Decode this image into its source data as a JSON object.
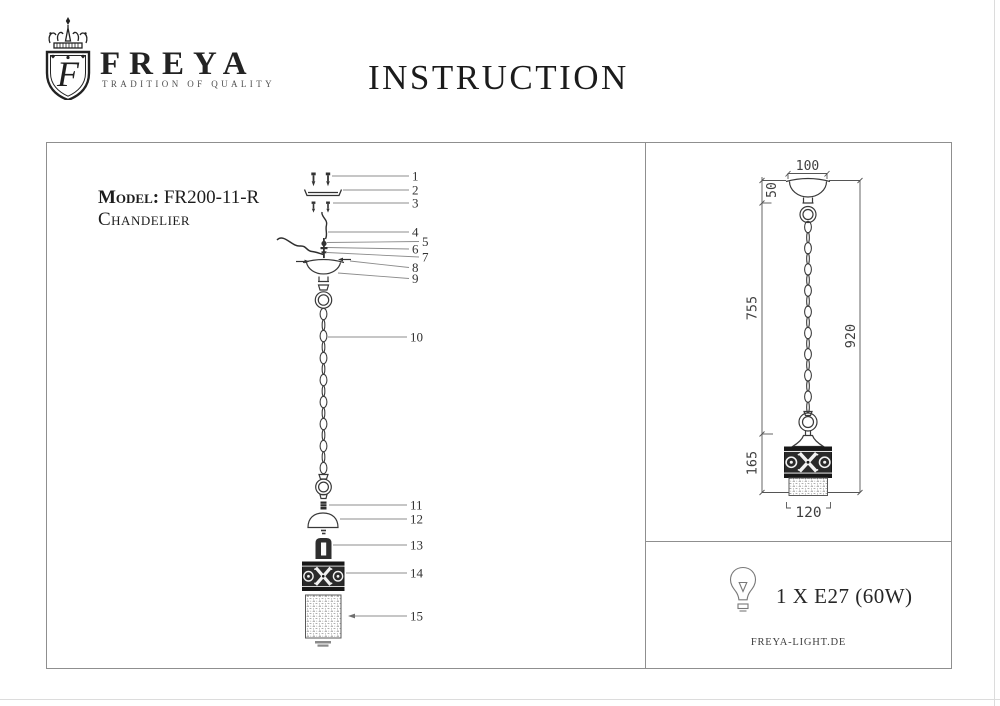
{
  "header": {
    "title": "INSTRUCTION",
    "brand": {
      "name": "FREYA",
      "tagline": "TRADITION OF QUALITY",
      "monogram": "F"
    }
  },
  "model": {
    "label": "Model:",
    "number": "FR200-11-R",
    "type": "Chandelier"
  },
  "parts": [
    "1",
    "2",
    "3",
    "4",
    "5",
    "6",
    "7",
    "8",
    "9",
    "10",
    "11",
    "12",
    "13",
    "14",
    "15"
  ],
  "dimensions": {
    "canopy_width": "100",
    "canopy_height": "50",
    "chain_length": "755",
    "overall_height": "920",
    "body_height": "165",
    "body_width": "120"
  },
  "spec": {
    "lamp": "1 X E27 (60W)",
    "website": "FREYA-LIGHT.DE"
  }
}
